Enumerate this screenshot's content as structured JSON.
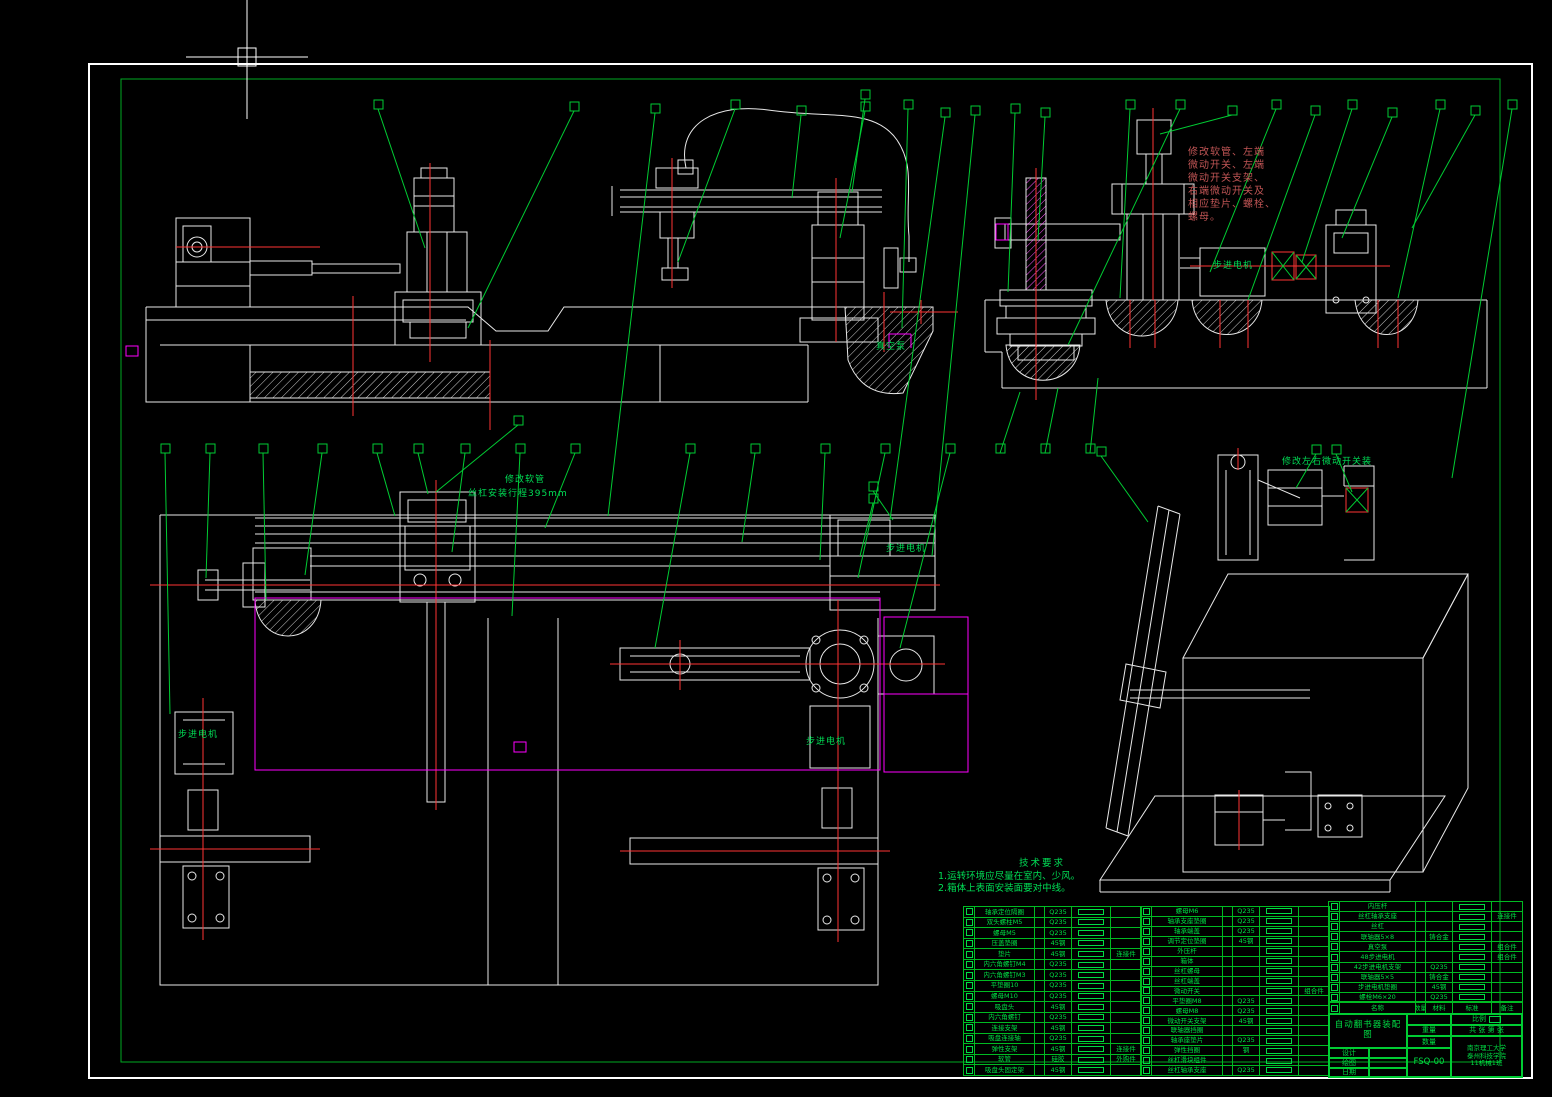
{
  "colors": {
    "background": "#000000",
    "line_white": "#e8e8e8",
    "leader_green": "#00cc33",
    "centerline_red": "#ff3333",
    "magenta": "#ff00ff",
    "note_red": "#c05555",
    "text_green": "#00dd55"
  },
  "annotations": {
    "hose_note_lines": [
      "修改软管、左端",
      "微动开关、左端",
      "微动开关支架、",
      "右端微动开关及",
      "相应垫片、螺栓、",
      "螺母。"
    ],
    "iso_note": "修改左右微动开关装",
    "rail_note_1": "修改软管",
    "rail_note_2": "丝杠安装行程395mm",
    "vacuum_pump": "真空泵",
    "stepper_motor": "步进电机"
  },
  "tech": {
    "title": "技术要求",
    "items": [
      "1.运转环境应尽量在室内、少风。",
      "2.箱体上表面安装面要对中线。"
    ]
  },
  "bom": {
    "headers": [
      "名称",
      "数量",
      "材料",
      "标准",
      "备注"
    ],
    "left": [
      {
        "name": "轴承定位隔圈",
        "qty": "",
        "material": "Q235",
        "remark": ""
      },
      {
        "name": "双头螺柱M5",
        "qty": "",
        "material": "Q235",
        "remark": ""
      },
      {
        "name": "螺母M5",
        "qty": "",
        "material": "Q235",
        "remark": ""
      },
      {
        "name": "压盖垫圈",
        "qty": "",
        "material": "45钢",
        "remark": ""
      },
      {
        "name": "垫片",
        "qty": "",
        "material": "45钢",
        "remark": "连接件"
      },
      {
        "name": "内六角螺钉M4",
        "qty": "",
        "material": "Q235",
        "remark": ""
      },
      {
        "name": "内六角螺钉M3",
        "qty": "",
        "material": "Q235",
        "remark": ""
      },
      {
        "name": "平垫圈10",
        "qty": "",
        "material": "Q235",
        "remark": ""
      },
      {
        "name": "螺母M10",
        "qty": "",
        "material": "Q235",
        "remark": ""
      },
      {
        "name": "吸盘头",
        "qty": "",
        "material": "45钢",
        "remark": ""
      },
      {
        "name": "内六角螺钉",
        "qty": "",
        "material": "Q235",
        "remark": ""
      },
      {
        "name": "连接支架",
        "qty": "",
        "material": "45钢",
        "remark": ""
      },
      {
        "name": "吸盘连接轴",
        "qty": "",
        "material": "Q235",
        "remark": ""
      },
      {
        "name": "弹性支架",
        "qty": "",
        "material": "45钢",
        "remark": "连接件"
      },
      {
        "name": "软管",
        "qty": "",
        "material": "硅胶",
        "remark": "外购件"
      },
      {
        "name": "吸盘头固定架",
        "qty": "",
        "material": "45钢",
        "remark": ""
      }
    ],
    "middle": [
      {
        "name": "螺母M6",
        "qty": "",
        "material": "Q235",
        "remark": ""
      },
      {
        "name": "轴承支座垫圈",
        "qty": "",
        "material": "Q235",
        "remark": ""
      },
      {
        "name": "轴承端盖",
        "qty": "",
        "material": "Q235",
        "remark": ""
      },
      {
        "name": "调节定位垫圈",
        "qty": "",
        "material": "45钢",
        "remark": ""
      },
      {
        "name": "外压杆",
        "qty": "",
        "material": "",
        "remark": ""
      },
      {
        "name": "箱体",
        "qty": "",
        "material": "",
        "remark": ""
      },
      {
        "name": "丝杠螺母",
        "qty": "",
        "material": "",
        "remark": ""
      },
      {
        "name": "丝杠端盖",
        "qty": "",
        "material": "",
        "remark": ""
      },
      {
        "name": "微动开关",
        "qty": "",
        "material": "",
        "remark": "组合件"
      },
      {
        "name": "平垫圈M8",
        "qty": "",
        "material": "Q235",
        "remark": ""
      },
      {
        "name": "螺母M8",
        "qty": "",
        "material": "Q235",
        "remark": ""
      },
      {
        "name": "微动开关支架",
        "qty": "",
        "material": "45钢",
        "remark": ""
      },
      {
        "name": "联轴器挡圈",
        "qty": "",
        "material": "",
        "remark": ""
      },
      {
        "name": "轴承座垫片",
        "qty": "",
        "material": "Q235",
        "remark": ""
      },
      {
        "name": "弹性挡圈",
        "qty": "",
        "material": "钢",
        "remark": ""
      },
      {
        "name": "丝杠滑块组件",
        "qty": "",
        "material": "",
        "remark": ""
      },
      {
        "name": "丝杠轴承支座",
        "qty": "",
        "material": "Q235",
        "remark": ""
      }
    ],
    "right": [
      {
        "name": "内压杆",
        "qty": "",
        "material": "",
        "remark": ""
      },
      {
        "name": "丝杠轴承支座",
        "qty": "",
        "material": "",
        "remark": "连接件"
      },
      {
        "name": "丝杠",
        "qty": "",
        "material": "",
        "remark": ""
      },
      {
        "name": "联轴器5×8",
        "qty": "",
        "material": "铸合金",
        "remark": ""
      },
      {
        "name": "真空泵",
        "qty": "",
        "material": "",
        "remark": "组合件"
      },
      {
        "name": "48步进电机",
        "qty": "",
        "material": "",
        "remark": "组合件"
      },
      {
        "name": "42步进电机支架",
        "qty": "",
        "material": "Q235",
        "remark": ""
      },
      {
        "name": "联轴器5×5",
        "qty": "",
        "material": "铸合金",
        "remark": ""
      },
      {
        "name": "步进电机垫圈",
        "qty": "",
        "material": "45钢",
        "remark": ""
      },
      {
        "name": "螺栓M6×20",
        "qty": "",
        "material": "Q235",
        "remark": ""
      }
    ]
  },
  "title_block": {
    "title_line1": "自动翻书器装配",
    "title_line2": "图",
    "drawing_no": "FSQ-00",
    "school_line1": "南京理工大学",
    "school_line2": "泰州科技学院",
    "class_line": "11机械1班",
    "scale_label": "比例",
    "sheets_label": "共 张  第 张",
    "weight_label": "重量",
    "qty_label": "数量",
    "role_1": "设计",
    "role_2": "绘图",
    "role_3": "日期"
  }
}
